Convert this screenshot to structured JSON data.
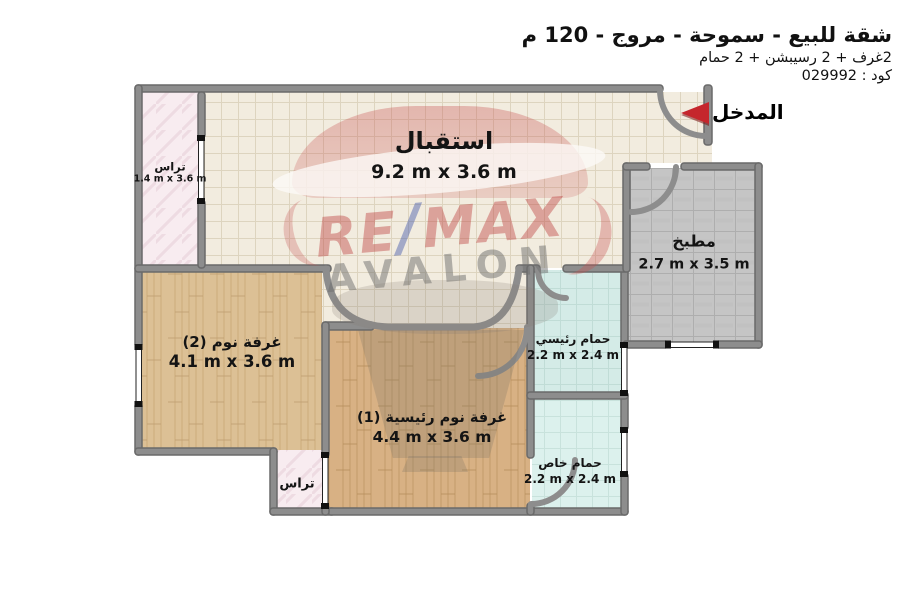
{
  "header": {
    "title": "شقة للبيع - سموحة - مروج - 120 م",
    "subtitle": "2غرف + 2 رسيبشن + 2 حمام",
    "code": "كود : 029992"
  },
  "entrance": {
    "label": "المدخل",
    "arrow_icon": "red-left-arrow",
    "arrow_color": "#c5262c"
  },
  "watermark": {
    "re": "RE",
    "slash": "/",
    "max": "MAX",
    "brand": "AVALON"
  },
  "rooms": {
    "reception": {
      "name": "استقبال",
      "dims": "9.2 m x 3.6 m"
    },
    "terrace_left": {
      "name": "تراس",
      "dims": "1.4 m x 3.6 m"
    },
    "kitchen": {
      "name": "مطبخ",
      "dims": "2.7 m x 3.5 m"
    },
    "bedroom2": {
      "name": "غرفة نوم (2)",
      "dims": "4.1 m x 3.6 m"
    },
    "master_bedroom": {
      "name": "غرفة نوم رئيسية (1)",
      "dims": "4.4 m x 3.6 m"
    },
    "main_bathroom": {
      "name": "حمام رئيسي",
      "dims": "2.2 m x 2.4 m"
    },
    "private_bathroom": {
      "name": "حمام خاص",
      "dims": "2.2 m x 2.4 m"
    },
    "terrace_bottom": {
      "name": "تراس",
      "dims": ""
    }
  },
  "colors": {
    "wall": "#8d8d8d",
    "reception_floor": "#f2ecdf",
    "kitchen_floor": "#c5c5c5",
    "bedroom_floor": "#dcc095",
    "master_floor": "#d8b184",
    "bathroom_floor": "#d4ebe7",
    "terrace_floor": "#f8ecf0",
    "accent_red": "#c5262c"
  }
}
